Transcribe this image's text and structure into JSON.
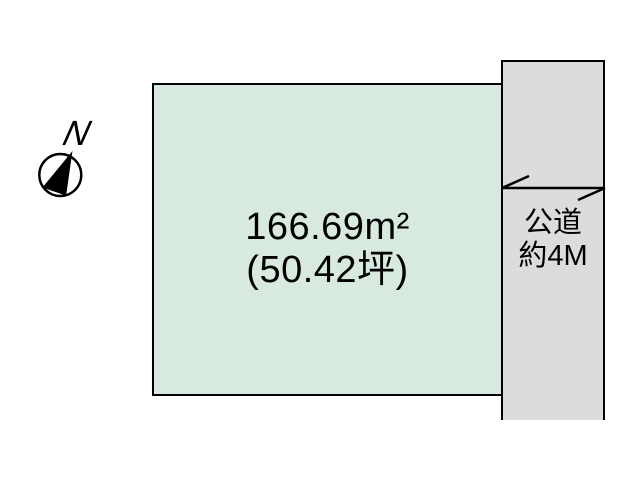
{
  "diagram": {
    "plot": {
      "area_m2": "166.69m²",
      "area_tsubo": "(50.42坪)",
      "fill_color": "#d8eae0"
    },
    "road": {
      "label_line1": "公道",
      "label_line2": "約4M",
      "fill_color": "#dcdcdc"
    },
    "compass": {
      "north_label": "N"
    },
    "line_color": "#000000"
  }
}
